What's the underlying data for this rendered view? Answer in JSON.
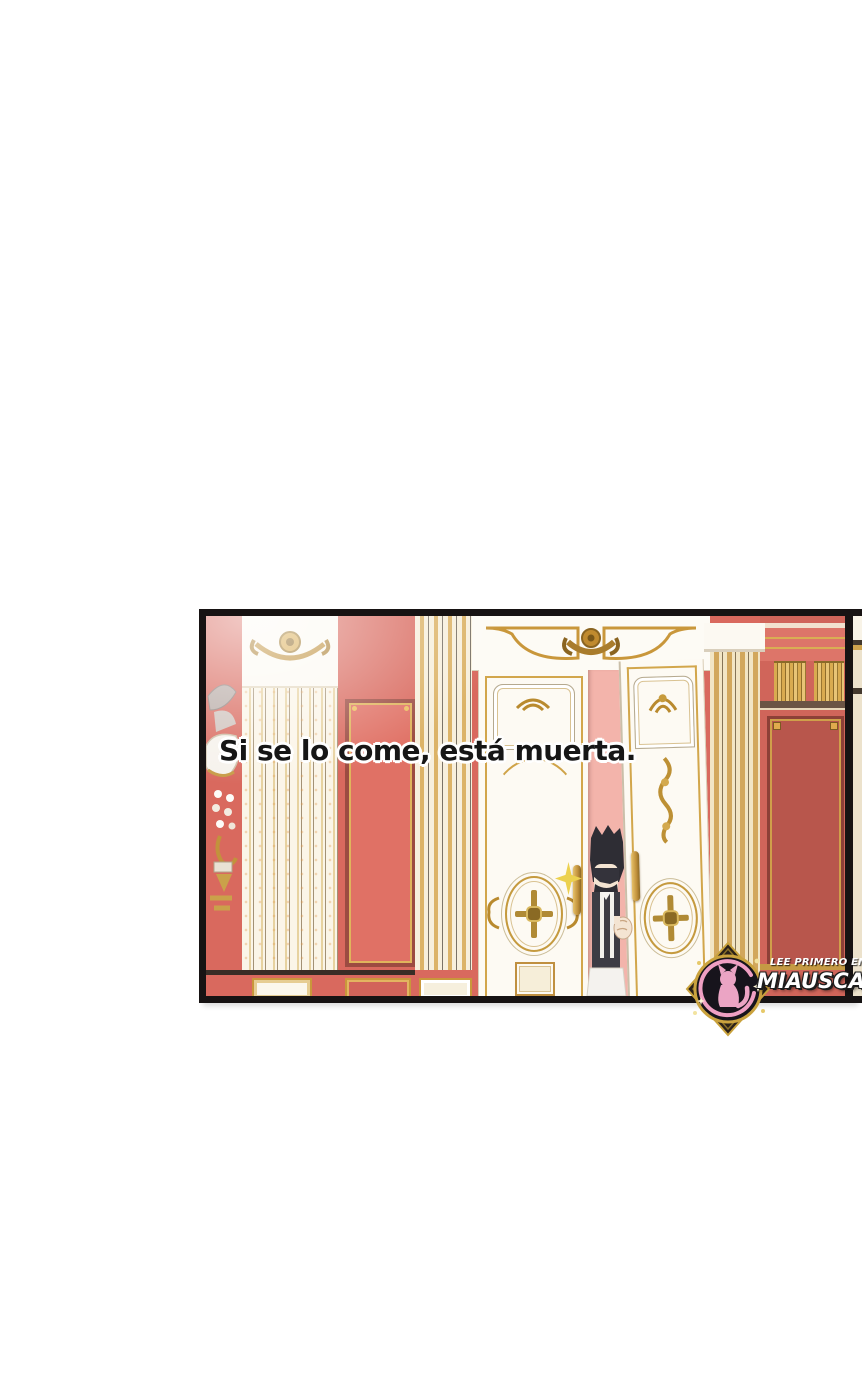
{
  "page": {
    "background": "#ffffff",
    "type": "webtoon-panel-screenshot"
  },
  "caption": {
    "text": "Si se lo come, está muerta."
  },
  "watermark": {
    "lead": "LEE PRIMERO EN:",
    "site": "MIAUSCAN.C",
    "logo": "miauscan-pink-cat-logo"
  },
  "panel": {
    "description": "Ornate palace hallway: coral-red walls with gold-framed panels, cream fluted columns, white double doors with gold rococo ornaments; a dark-haired maid peeks through the door gap beside a gold sparkle.",
    "colors": {
      "wall_red": "#d9695e",
      "wall_red_dark": "#b8564c",
      "panel_frame_red": "#9c4b41",
      "gold": "#c9973b",
      "cream": "#f6edd8",
      "door_white": "#fdfaf3",
      "gap_pink": "#f3b4ab",
      "border_black": "#171313",
      "sparkle_gold": "#ecd14f",
      "logo_pink": "#eba4c4"
    }
  }
}
